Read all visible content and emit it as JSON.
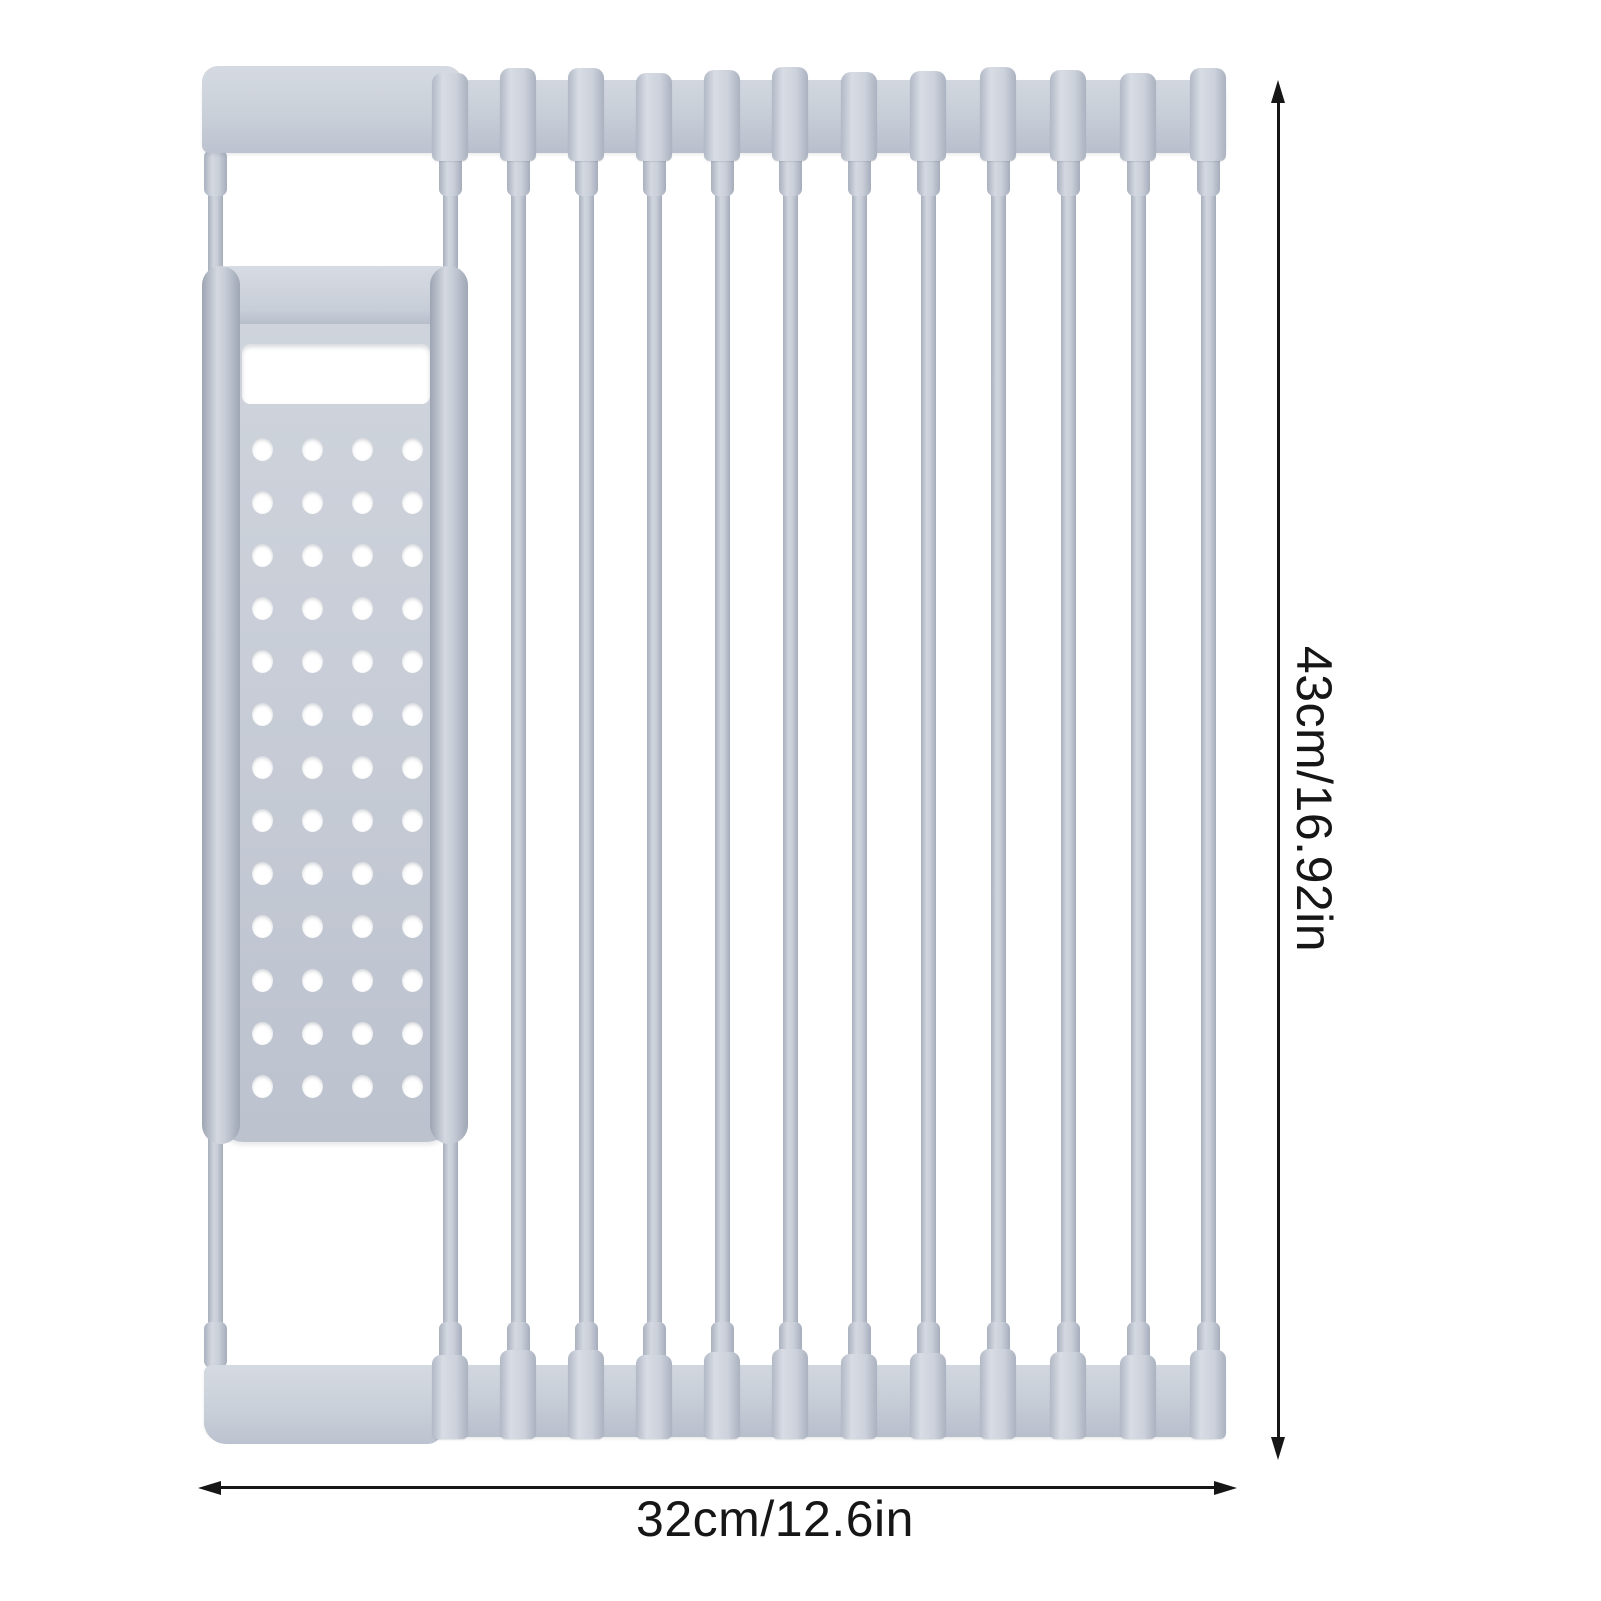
{
  "annotations": {
    "height_label": "43cm/16.92in",
    "width_label": "32cm/12.6in",
    "line_color": "#161616",
    "text_color": "#161616"
  },
  "rack": {
    "description": "gray roll-up dish drying rack",
    "base_color": "#c6ccd6",
    "highlight_color": "#d8dce4",
    "shadow_color": "#a4abb9",
    "rod_count": 13,
    "rod_centers_x": [
      215,
      450,
      518,
      586,
      654,
      722,
      790,
      859,
      928,
      998,
      1068,
      1138,
      1208
    ],
    "panel": {
      "hole_rows": 13,
      "hole_cols": 4,
      "hole_col_x": [
        60,
        110,
        160,
        210
      ],
      "hole_row_start_y": 184,
      "hole_row_spacing": 53.1,
      "hole_diameter": 21
    }
  }
}
